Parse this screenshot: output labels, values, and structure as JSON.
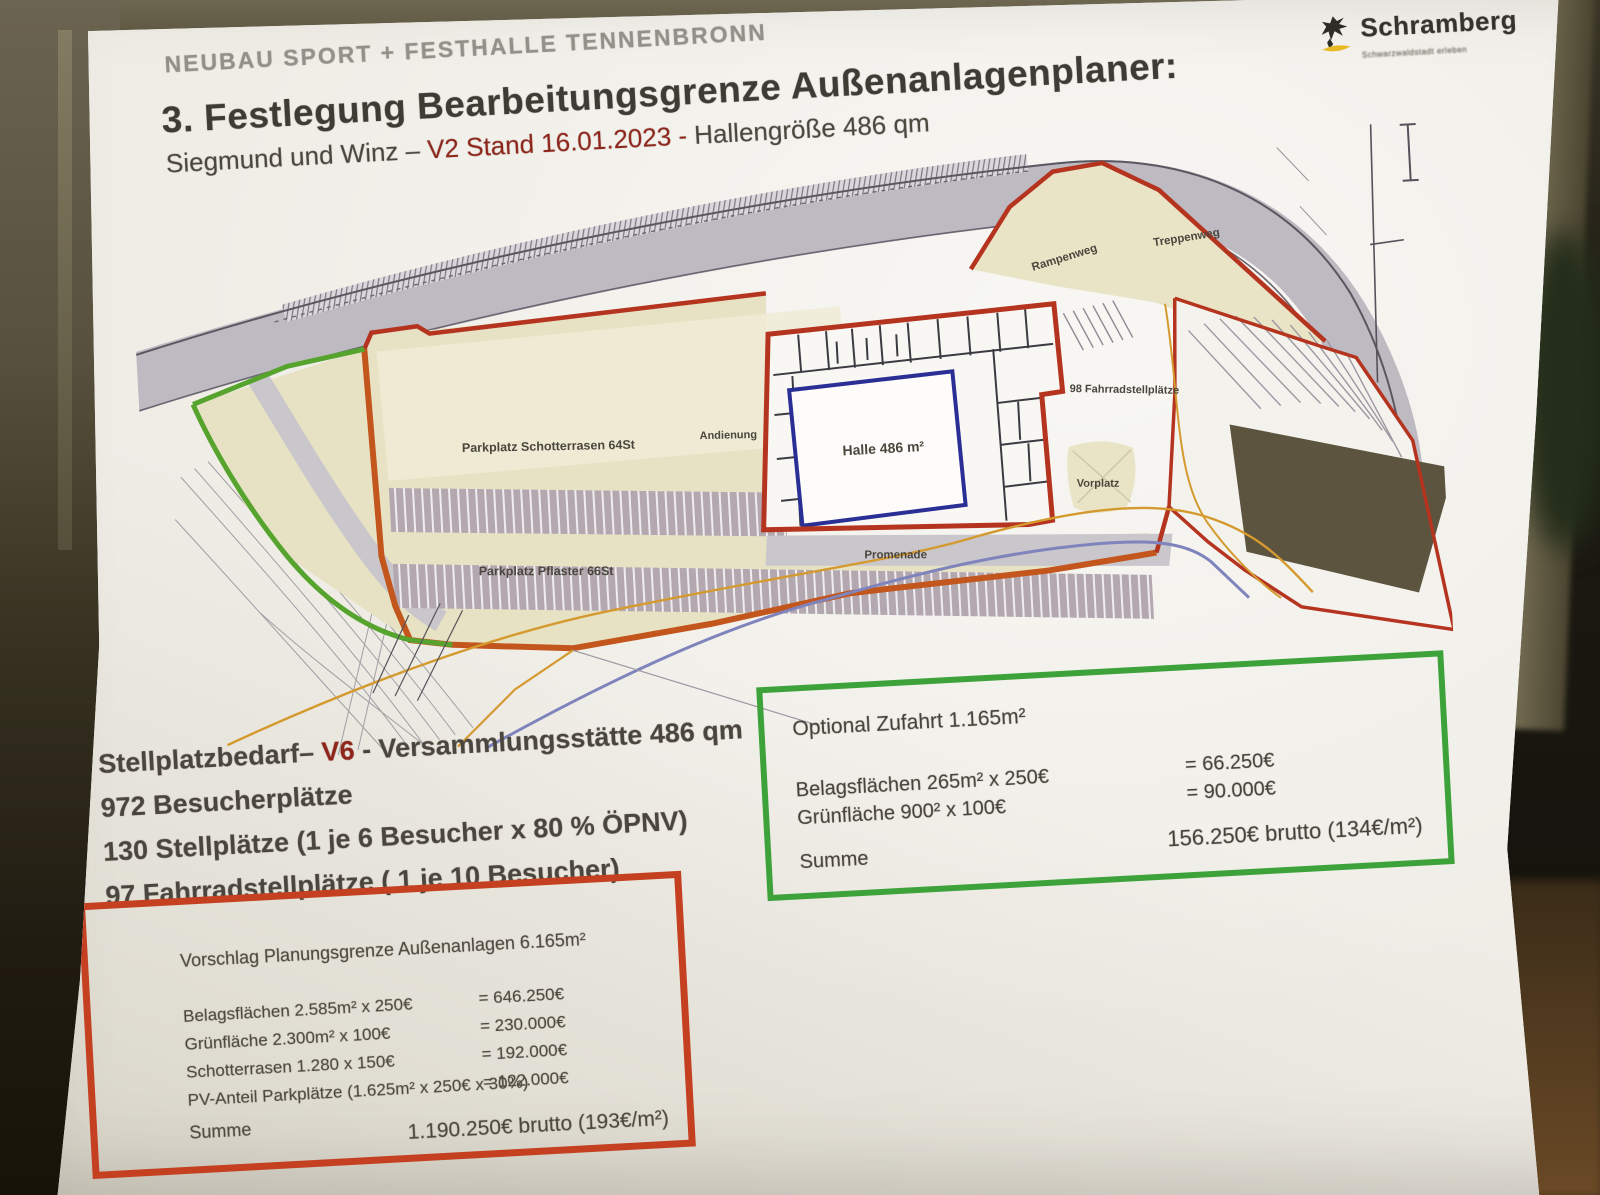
{
  "header": {
    "project": "NEUBAU SPORT + FESTHALLE TENNENBRONN",
    "title": "3. Festlegung Bearbeitungsgrenze Außenanlagenplaner:",
    "subtitle_prefix": "Siegmund und Winz – ",
    "subtitle_highlight": "V2 Stand 16.01.2023 - ",
    "subtitle_suffix": "Hallengröße 486 qm"
  },
  "logo": {
    "name": "Schramberg",
    "tagline": "Schwarzwaldstadt erleben",
    "accent_color": "#e8b923"
  },
  "plan": {
    "labels": {
      "parkplatz_schotterrasen": "Parkplatz Schotterrasen 64St",
      "parkplatz_pflaster": "Parkplatz Pflaster 66St",
      "andienung": "Andienung",
      "halle": "Halle 486 m²",
      "promenade": "Promenade",
      "fahrradstellplaetze": "98 Fahrradstellplätze",
      "vorplatz": "Vorplatz",
      "rampenweg": "Rampenweg",
      "treppenweg": "Treppenweg"
    },
    "colors": {
      "boundary_red": "#b5341f",
      "boundary_green": "#56a42e",
      "hall_blue": "#2a2f96",
      "site_beige": "#e8e3c4",
      "road_gray": "#bdbac2"
    }
  },
  "stellplatzbedarf": {
    "title_prefix": "Stellplatzbedarf– ",
    "title_highlight": "V6",
    "title_suffix": " - Versammlungsstätte 486 qm",
    "lines": [
      "972 Besucherplätze",
      "130 Stellplätze (1 je 6 Besucher x 80 % ÖPNV)",
      "97 Fahrradstellplätze ( 1 je 10 Besucher)"
    ]
  },
  "green_box": {
    "title": "Optional Zufahrt 1.165m²",
    "rows": [
      {
        "label": "Belagsflächen 265m² x 250€",
        "value": "= 66.250€"
      },
      {
        "label": "Grünfläche 900² x 100€",
        "value": "= 90.000€"
      }
    ],
    "sum_label": "Summe",
    "sum_value": "156.250€ brutto (134€/m²)"
  },
  "red_box": {
    "title": "Vorschlag Planungsgrenze Außenanlagen 6.165m²",
    "rows": [
      {
        "label": "Belagsflächen 2.585m² x 250€",
        "value": "= 646.250€"
      },
      {
        "label": "Grünfläche 2.300m² x 100€",
        "value": "= 230.000€"
      },
      {
        "label": "Schotterrasen 1.280 x 150€",
        "value": "= 192.000€"
      },
      {
        "label": "PV-Anteil Parkplätze (1.625m² x 250€ x 30%)",
        "value": "= 122.000€"
      }
    ],
    "sum_label": "Summe",
    "sum_value": "1.190.250€ brutto (193€/m²)"
  }
}
